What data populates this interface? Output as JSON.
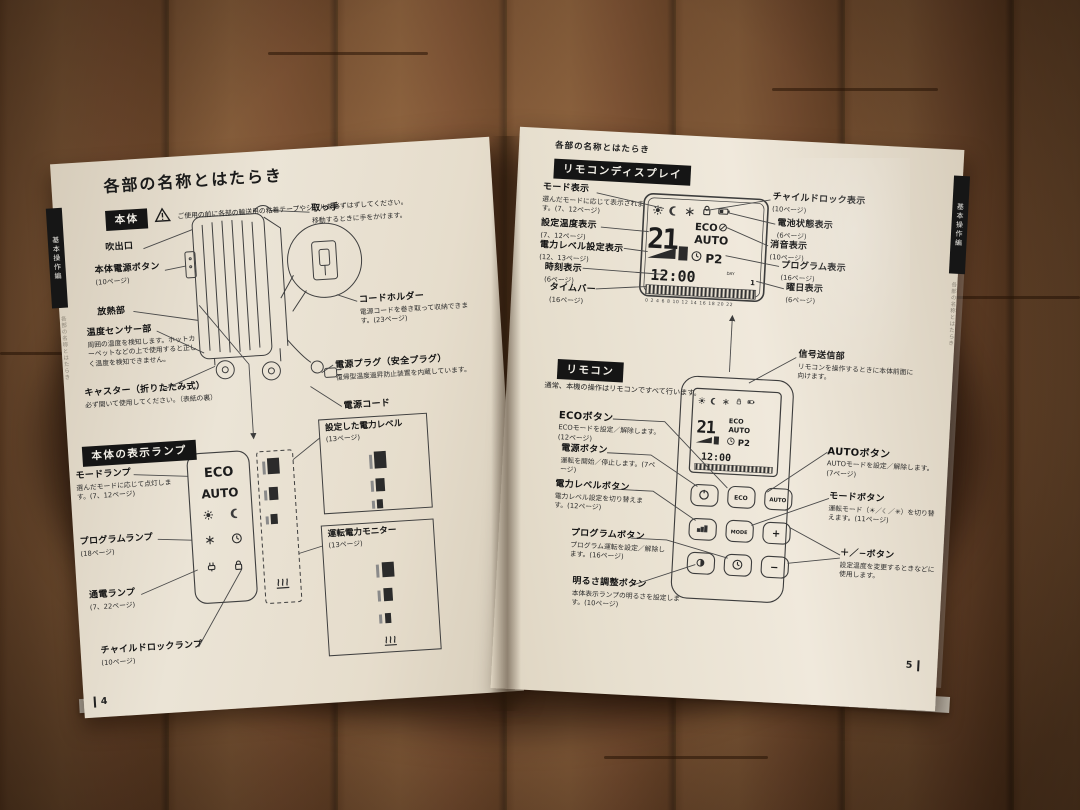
{
  "left_page": {
    "title": "各部の名称とはたらき",
    "side_tab": "基本操作編",
    "side_caption": "各部の名称とはたらき",
    "page_number": "4",
    "body": {
      "badge": "本体",
      "note": "ご使用の前に各部の輸送用の粘着テープやシールを必ずはずしてください。",
      "labels": {
        "outlet": {
          "name": "吹出口"
        },
        "power_button": {
          "name": "本体電源ボタン",
          "sub": "(10ページ)"
        },
        "radiator": {
          "name": "放熱部"
        },
        "sensor": {
          "name": "温度センサー部",
          "sub": "周囲の温度を検知します。ホットカーペットなどの上で使用すると正しく温度を検知できません。"
        },
        "caster": {
          "name": "キャスター（折りたたみ式）",
          "sub": "必ず開いて使用してください。（表紙の裏）"
        },
        "handle": {
          "name": "取っ手",
          "sub": "移動するときに手をかけます。"
        },
        "cord_holder": {
          "name": "コードホルダー",
          "sub": "電源コードを巻き取って収納できます。(23ページ)"
        },
        "plug": {
          "name": "電源プラグ（安全プラグ）",
          "sub": "復帰型温度過昇防止装置を内蔵しています。"
        },
        "cord": {
          "name": "電源コード"
        }
      }
    },
    "lamps": {
      "badge": "本体の表示ランプ",
      "panel": {
        "eco": "ECO",
        "auto": "AUTO"
      },
      "labels": {
        "mode": {
          "name": "モードランプ",
          "sub": "選んだモードに応じて点灯します。(7、12ページ)"
        },
        "program": {
          "name": "プログラムランプ",
          "sub": "(18ページ)"
        },
        "power_on": {
          "name": "通電ランプ",
          "sub": "(7、22ページ)"
        },
        "child_lock": {
          "name": "チャイルドロックランプ",
          "sub": "(10ページ)"
        },
        "set_level": {
          "name": "設定した電力レベル",
          "sub": "(13ページ)"
        },
        "monitor": {
          "name": "運転電力モニター",
          "sub": "(13ページ)"
        }
      }
    }
  },
  "right_page": {
    "header": "各部の名称とはたらき",
    "side_tab": "基本操作編",
    "side_caption": "各部の名称とはたらき",
    "page_number": "5",
    "display": {
      "badge": "リモコンディスプレイ",
      "lcd": {
        "temp": "21",
        "eco": "ECO",
        "auto": "AUTO",
        "program": "P2",
        "time": "12:00",
        "day": "1",
        "day_caption": "DAY",
        "timebar_numbers": "0 2 4 6 8 10 12 14 16 18 20 22"
      },
      "labels_left": {
        "mode": {
          "name": "モード表示",
          "sub": "選んだモードに応じて表示されます。(7、12ページ)"
        },
        "set_temp": {
          "name": "設定温度表示",
          "sub": "(7、12ページ)"
        },
        "level": {
          "name": "電力レベル設定表示",
          "sub": "(12、13ページ)"
        },
        "clock": {
          "name": "時刻表示",
          "sub": "(6ページ)"
        },
        "timebar": {
          "name": "タイムバー",
          "sub": "(16ページ)"
        }
      },
      "labels_right": {
        "child_lock": {
          "name": "チャイルドロック表示",
          "sub": "(10ページ)"
        },
        "battery": {
          "name": "電池状態表示",
          "sub": "(6ページ)"
        },
        "mute": {
          "name": "消音表示",
          "sub": "(10ページ)"
        },
        "program": {
          "name": "プログラム表示",
          "sub": "(16ページ)"
        },
        "weekday": {
          "name": "曜日表示",
          "sub": "(6ページ)"
        }
      }
    },
    "remote": {
      "badge": "リモコン",
      "intro": "通常、本機の操作はリモコンですべて行います。",
      "buttons": {
        "eco": "ECO",
        "auto": "AUTO",
        "mode": "MODE",
        "plus": "+",
        "minus": "−"
      },
      "labels_left": {
        "eco": {
          "name": "ECOボタン",
          "sub": "ECOモードを設定／解除します。(12ページ)"
        },
        "power": {
          "name": "電源ボタン",
          "sub": "運転を開始／停止します。(7ページ)"
        },
        "level": {
          "name": "電力レベルボタン",
          "sub": "電力レベル設定を切り替えます。(12ページ)"
        },
        "program": {
          "name": "プログラムボタン",
          "sub": "プログラム運転を設定／解除します。(16ページ)"
        },
        "brightness": {
          "name": "明るさ調整ボタン",
          "sub": "本体表示ランプの明るさを設定します。(10ページ)"
        }
      },
      "labels_right": {
        "signal": {
          "name": "信号送信部",
          "sub": "リモコンを操作するときに本体前面に向けます。"
        },
        "auto": {
          "name": "AUTOボタン",
          "sub": "AUTOモードを設定／解除します。(7ページ)"
        },
        "mode": {
          "name": "モードボタン",
          "sub": "運転モード（☀／☾／✳）を切り替えます。(11ページ)"
        },
        "plus_minus": {
          "name": "＋／−ボタン",
          "sub": "設定温度を変更するときなどに使用します。"
        }
      }
    },
    "icon_names": [
      "sun-icon",
      "moon-icon",
      "frost-icon",
      "clock-icon",
      "lock-icon",
      "plug-icon",
      "battery-icon",
      "heat-icon",
      "power-icon",
      "mute-icon",
      "level-bars-icon",
      "brightness-icon",
      "warning-icon"
    ]
  }
}
